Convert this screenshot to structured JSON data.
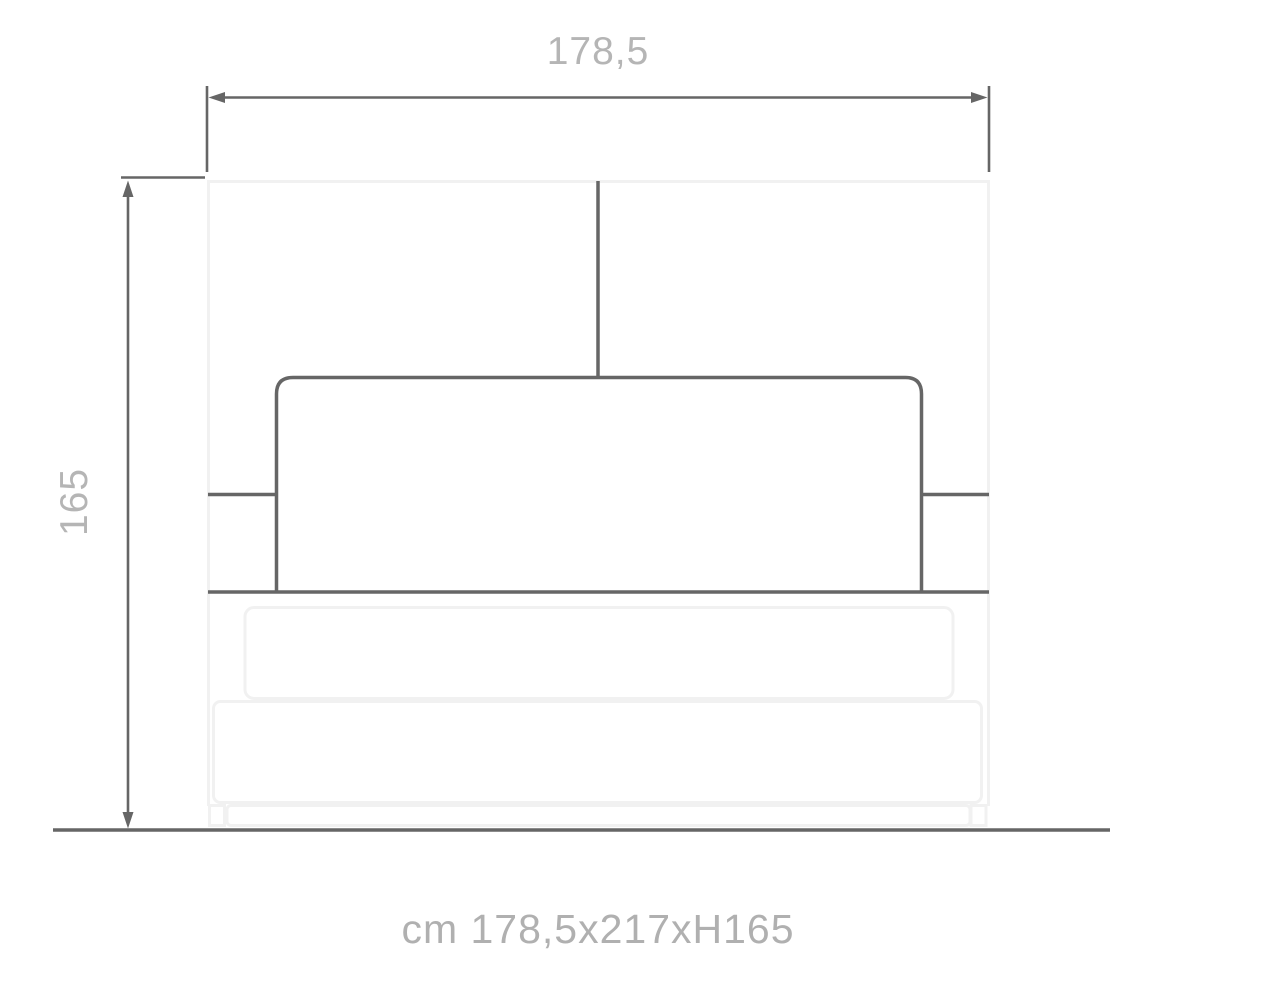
{
  "diagram": {
    "type": "furniture-dimension-drawing",
    "subject": "bed front elevation technical drawing",
    "dimensions": {
      "width_label": "178,5",
      "height_label": "165",
      "caption": "cm 178,5x217xH165"
    },
    "colors": {
      "dark_line": "#666666",
      "light_line": "#f1f1f1",
      "dimension_text": "#b5b5b5",
      "caption_text": "#b0b0b0",
      "background": "#ffffff"
    }
  }
}
